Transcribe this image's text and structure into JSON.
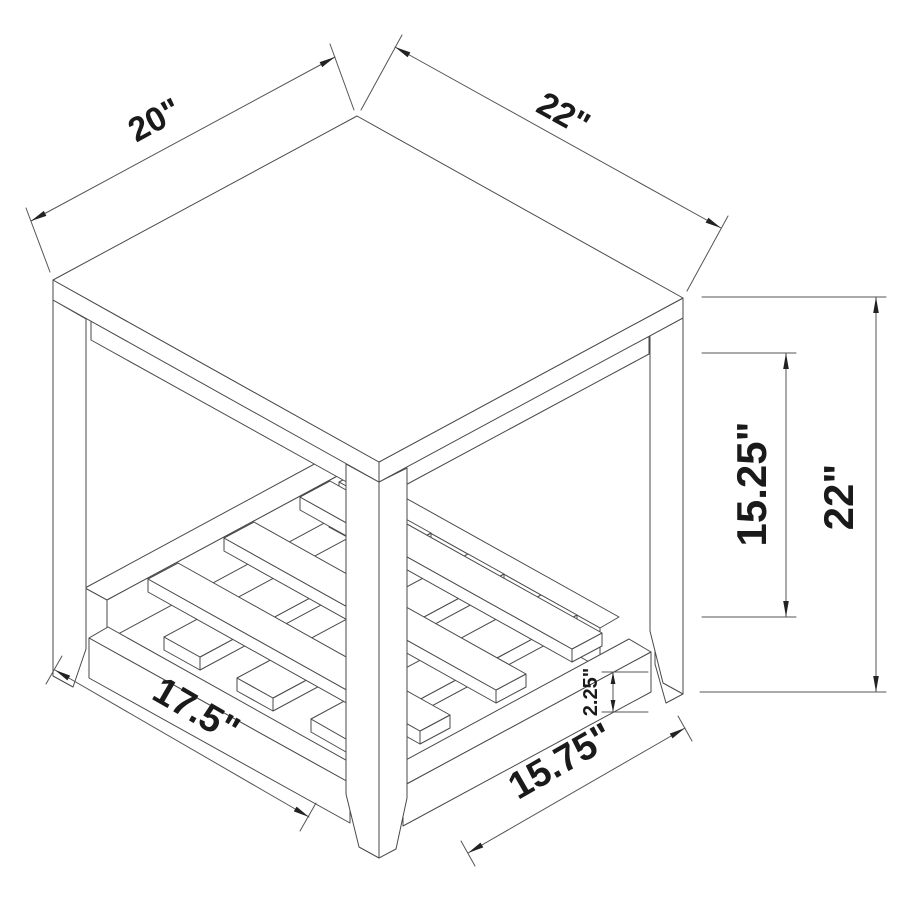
{
  "drawing": {
    "subject": "end-table-isometric-dimension-drawing",
    "colors": {
      "background": "#ffffff",
      "line": "#4a4a4a",
      "dimension_line": "#555555",
      "label": "#1a1a1a"
    },
    "dimensions": {
      "top_left_edge": {
        "label": "20\""
      },
      "top_right_edge": {
        "label": "22\""
      },
      "shelf_clearance": {
        "label": "15.25\""
      },
      "overall_height": {
        "label": "22\""
      },
      "bottom_left_rail": {
        "label": "17.5\""
      },
      "bottom_right_rail": {
        "label": "15.75\""
      },
      "rail_height": {
        "label": "2.25\""
      }
    }
  }
}
